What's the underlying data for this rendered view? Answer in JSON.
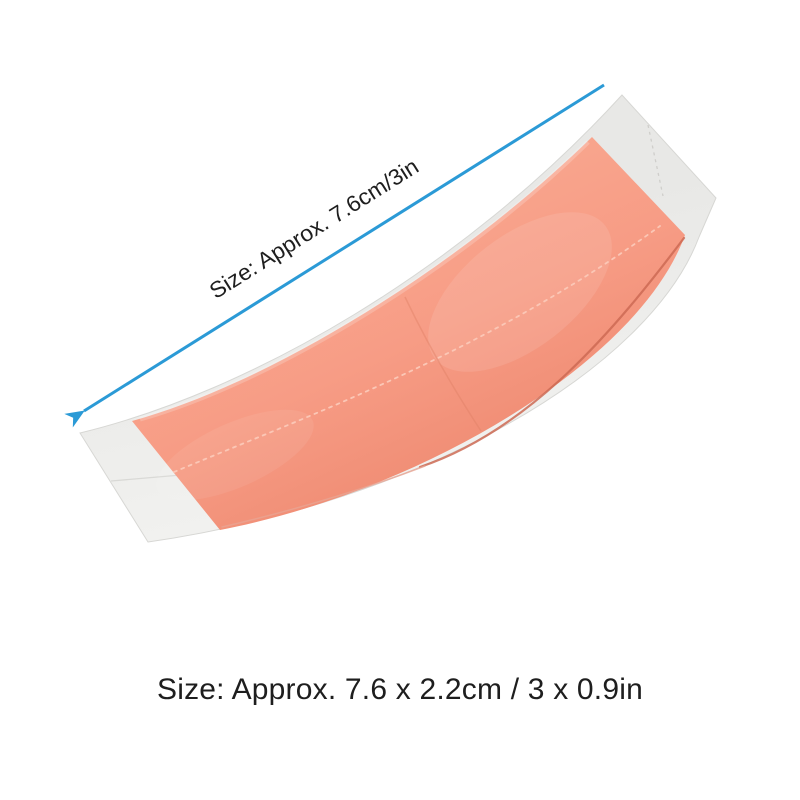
{
  "labels": {
    "diagonal_measure": "Size: Approx. 7.6cm/3in",
    "caption": "Size: Approx. 7.6 x 2.2cm / 3 x 0.9in"
  },
  "measurements": {
    "length_cm": "7.6",
    "length_in": "3",
    "width_cm": "2.2",
    "width_in": "0.9"
  },
  "icons": {
    "measurement_arrow": "diagonal-line-with-arrowhead-lower-left"
  },
  "colors": {
    "background": "#ffffff",
    "arrow": "#2b9ad6",
    "text": "#1e1e1e",
    "tape_light": "#f9a78f",
    "tape_main": "#f79c85",
    "tape_dark": "#ee8970",
    "tape_edge_dark": "#cd6a54",
    "tape_edge_light": "#e9a492",
    "stitch": "#fbc7b6",
    "seam": "#e08166",
    "backing_top": "#e8e8e6",
    "backing_bottom": "#f4f4f2",
    "backing_edge": "#d7d7d4",
    "crease": "#d9d9d6",
    "tab_perforation": "#cfcecb"
  }
}
